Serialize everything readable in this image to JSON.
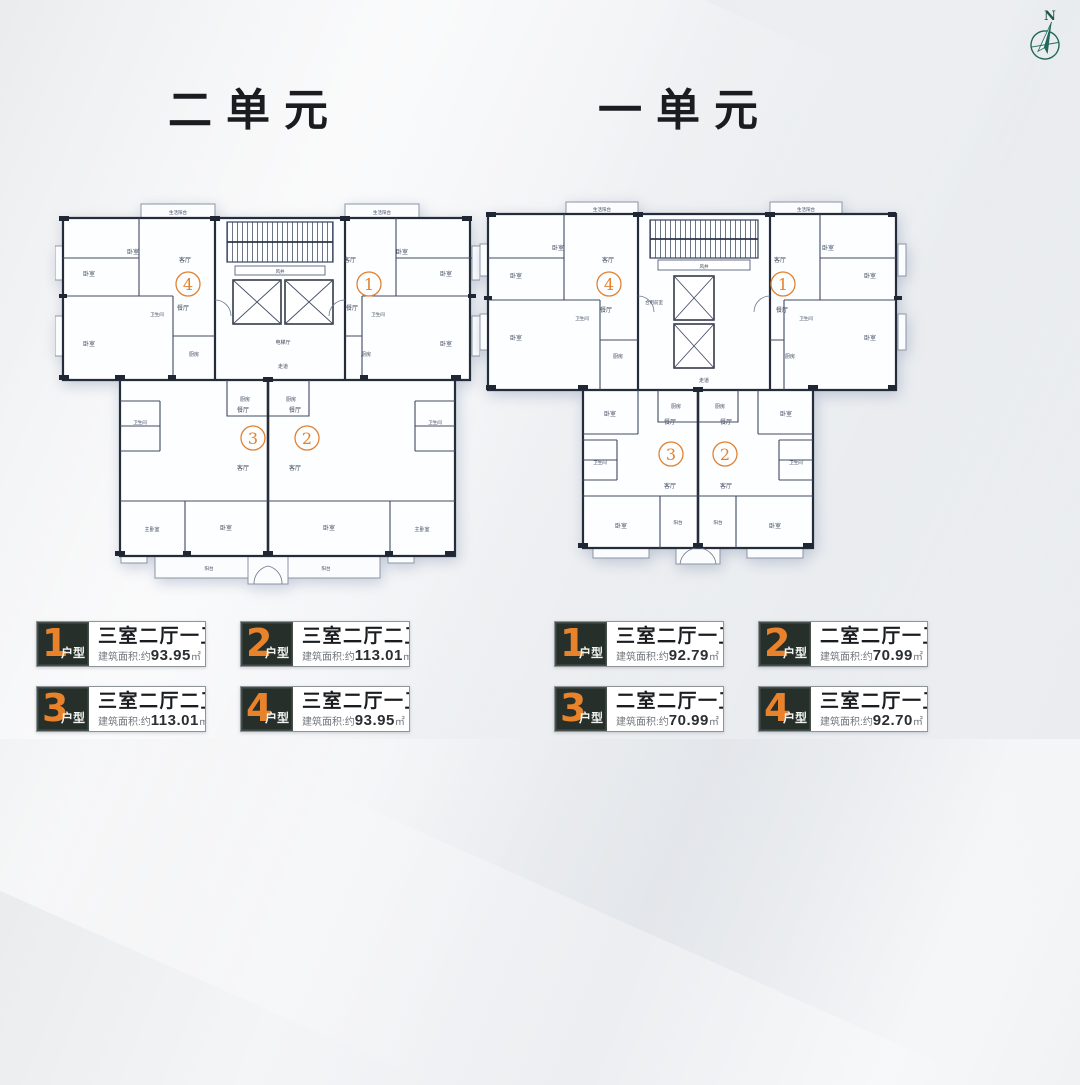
{
  "titles": {
    "unit2": "二单元",
    "unit1": "一单元"
  },
  "compass": {
    "label": "N"
  },
  "plan_labels": {
    "bedroom": "卧室",
    "master_bedroom": "主卧室",
    "living_room": "客厅",
    "dining_room": "餐厅",
    "kitchen": "厨房",
    "bathroom": "卫生间",
    "balcony": "阳台",
    "life_balcony": "生活阳台",
    "elevator_hall": "电梯厅",
    "shared_lobby": "合用前室",
    "corridor": "走道",
    "air_shaft": "风井"
  },
  "unit_numbers": {
    "n1": "1",
    "n2": "2",
    "n3": "3",
    "n4": "4"
  },
  "legend": {
    "type_suffix": "户型",
    "area_prefix": "建筑面积:约",
    "area_unit": "㎡",
    "unit2": [
      {
        "num": "1",
        "layout": "三室二厅一卫",
        "area": "93.95"
      },
      {
        "num": "2",
        "layout": "三室二厅二卫",
        "area": "113.01"
      },
      {
        "num": "3",
        "layout": "三室二厅二卫",
        "area": "113.01"
      },
      {
        "num": "4",
        "layout": "三室二厅一卫",
        "area": "93.95"
      }
    ],
    "unit1": [
      {
        "num": "1",
        "layout": "三室二厅一卫",
        "area": "92.79"
      },
      {
        "num": "2",
        "layout": "二室二厅一卫",
        "area": "70.99"
      },
      {
        "num": "3",
        "layout": "二室二厅一卫",
        "area": "70.99"
      },
      {
        "num": "4",
        "layout": "三室二厅一卫",
        "area": "92.70"
      }
    ]
  },
  "colors": {
    "accent_orange": "#e2812f",
    "wall_dark": "#262d3a",
    "legend_dark_bg": "#262f2a",
    "compass_green": "#20695a"
  }
}
